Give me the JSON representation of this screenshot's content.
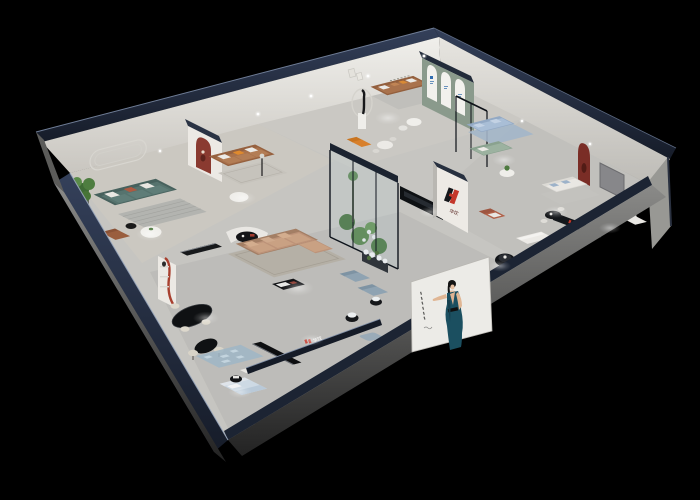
{
  "window": {
    "width": 700,
    "height": 500,
    "background": "#000000",
    "subject": "Isometric cutaway 3D render of a furniture showroom interior at night"
  },
  "brand": {
    "mark": "H",
    "characters": "华饮",
    "mark_black": "#15171b",
    "mark_red": "#c4372a"
  },
  "signs": {
    "pillar_logo_characters": "华饮",
    "corridor_sign_characters": "华饮",
    "shelf_sign_characters": "华饮"
  },
  "poster": {
    "description": "fashion poster of a woman in a dark teal halter dress",
    "background": "#ecebe7",
    "dress_color": "#1b4f60",
    "hair_color": "#131313",
    "skin_color": "#e6c0a2",
    "side_text_marks": 6
  },
  "palette": {
    "exterior_wall_navy": "#222b3a",
    "wall_face_white": "#e9e7e2",
    "floor_gray": "#c6c5c1",
    "slab_gray": "#6f6f6d",
    "accent_red": "#a03a2e",
    "accent_orange": "#df8a2e",
    "sofa_teal": "#5d7a75",
    "sofa_leather_brown": "#a9724c",
    "sofa_tan": "#bf9479",
    "sofa_light_blue": "#a9bed6",
    "sofa_sage_green": "#9cb2a0",
    "sofa_blue_gray": "#8fa3b2",
    "arch_wall_green": "#8a9a8c",
    "plant_green": "#4e7a40",
    "glass_tint": "#bcd3d8"
  },
  "areas": [
    "teal-sofa-lounge",
    "leather-sofa-lounge",
    "center-sectional-lounge",
    "gallery-lounge",
    "arched-display-wall",
    "blue-sofa-room",
    "glass-atrium",
    "white-sofa-suites",
    "dining-display",
    "bedroom-display",
    "entry-corridor"
  ]
}
